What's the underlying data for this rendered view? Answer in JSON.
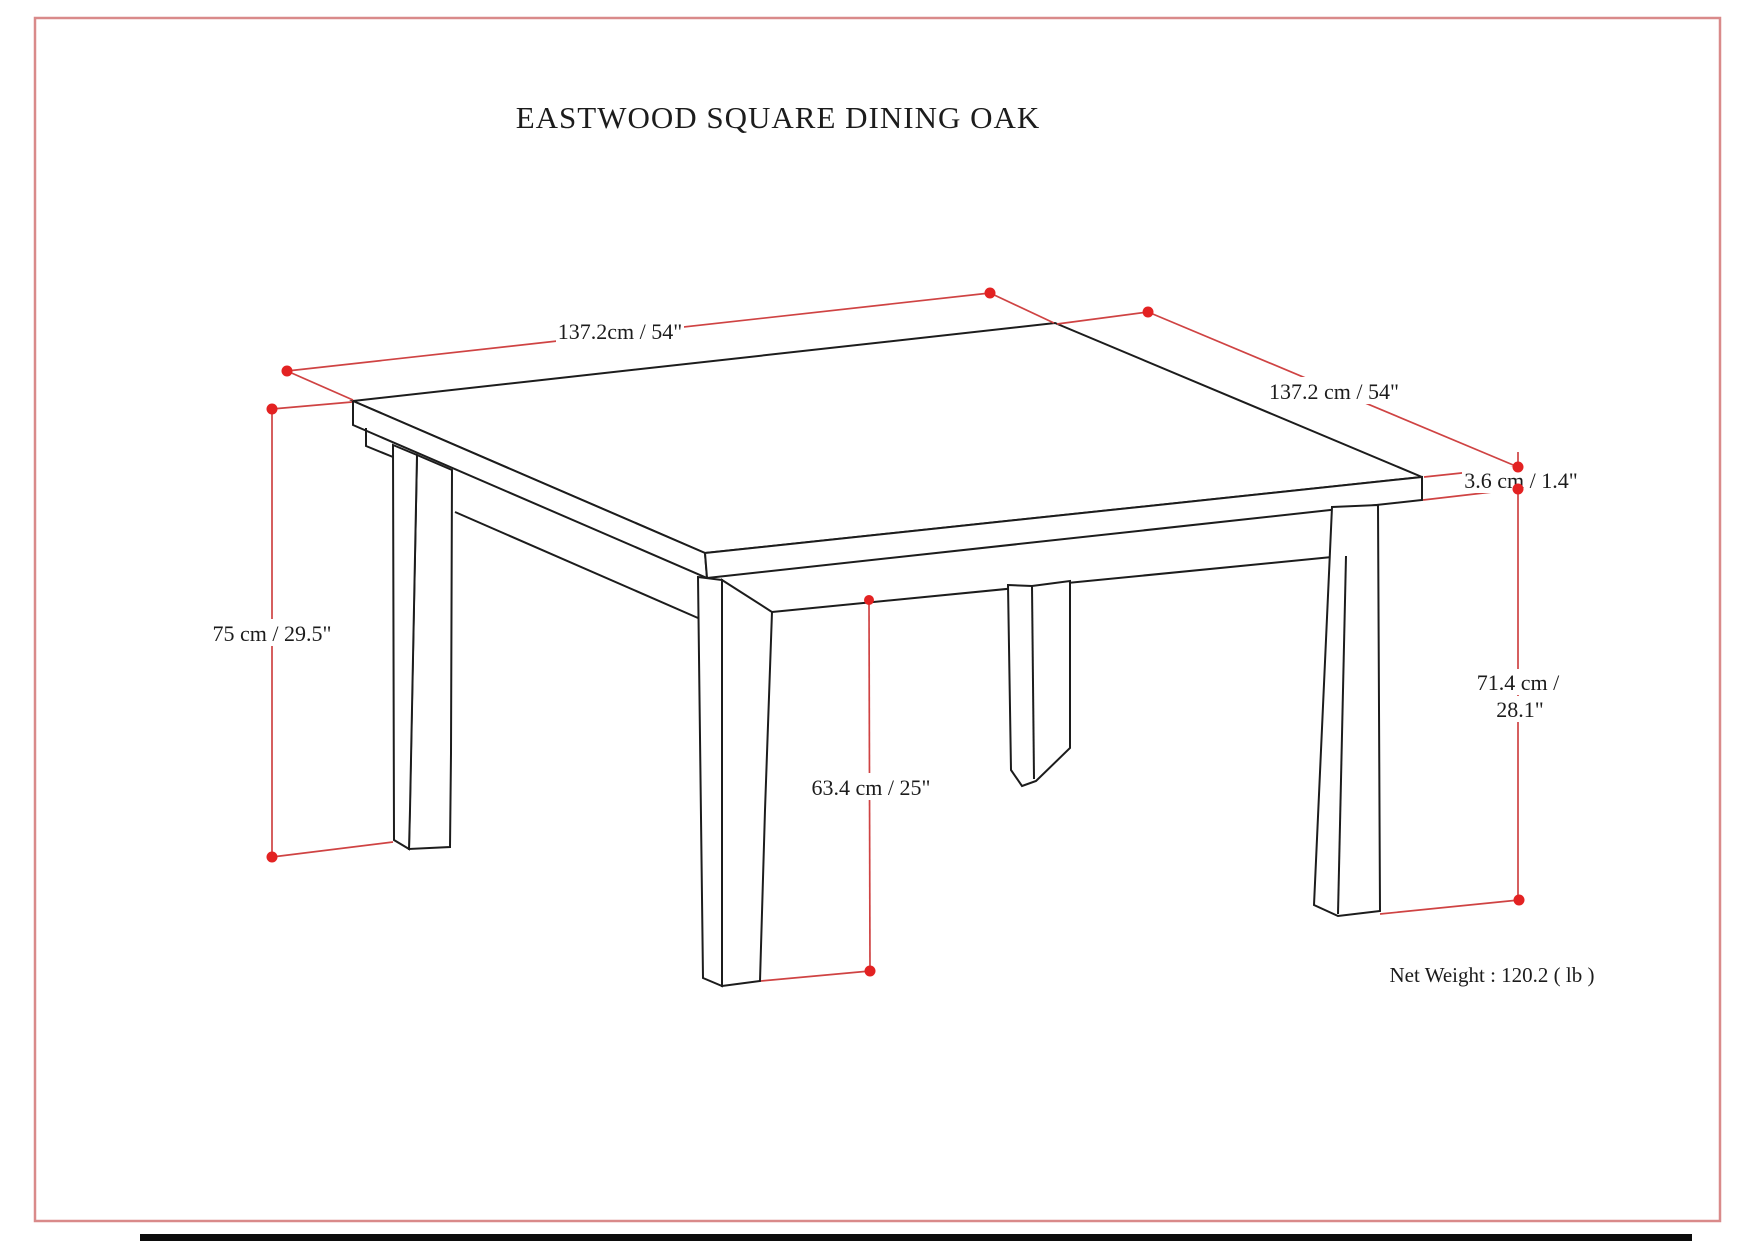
{
  "page": {
    "title": "EASTWOOD SQUARE DINING OAK",
    "net_weight": "Net Weight : 120.2 ( lb )"
  },
  "dimension_labels": {
    "top_width": "137.2cm / 54\"",
    "top_depth": "137.2 cm / 54\"",
    "top_thickness": "3.6 cm / 1.4\"",
    "overall_height": "75 cm / 29.5\"",
    "leg_height_line1": "71.4 cm /",
    "leg_height_line2": "28.1\"",
    "floor_to_apron": "63.4 cm / 25\""
  },
  "colors": {
    "page_border": "#d98a8a",
    "dimension_line": "#cf4343",
    "dimension_dot": "#e32222",
    "drawing_line": "#1c1c1c",
    "background": "#ffffff"
  }
}
